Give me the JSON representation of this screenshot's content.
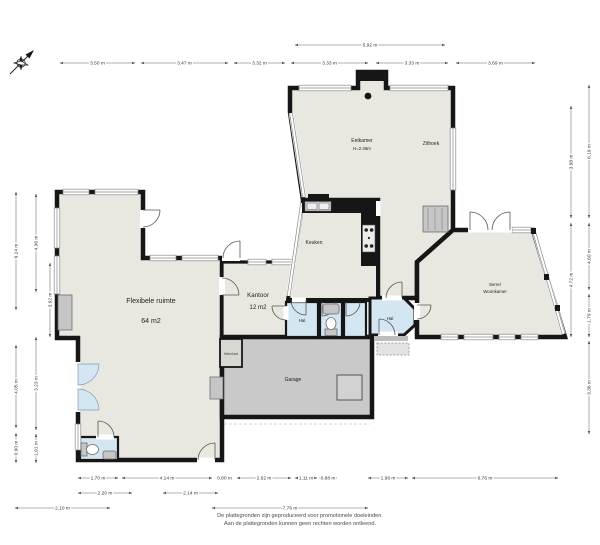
{
  "footer": {
    "line1": "De plattegronden zijn geproduceerd voor promotionele doeleinden.",
    "line2": "Aan de plattegronden kunnen geen rechten worden ontleend."
  },
  "rooms": {
    "eetkamer": {
      "label": "Eetkamer",
      "height": "H=2.46m"
    },
    "zithoek": {
      "label": "Zithoek"
    },
    "keuken": {
      "label": "Keuken"
    },
    "kantoor": {
      "label": "Kantoor",
      "area": "12 m2"
    },
    "flexibele": {
      "label": "Flexibele ruimte",
      "area": "64 m2"
    },
    "serre": {
      "line1": "Serre/",
      "line2": "Woonkamer"
    },
    "hal_left": {
      "label": "Hal"
    },
    "hal_right": {
      "label": "Hal"
    },
    "garage": {
      "label": "Garage"
    },
    "meterkast": {
      "label": "Meterkast"
    }
  },
  "colors": {
    "wall": "#161616",
    "floor": "#e9e8e0",
    "garage_floor": "#c9c9c9",
    "wet_room": "#d3e6f2",
    "fixture": "#c6c6c6"
  },
  "dimensions": [
    {
      "label": "5.92 m",
      "x1": 295,
      "y1": 45,
      "x2": 445,
      "y2": 45,
      "o": "h"
    },
    {
      "label": "3.50 m",
      "x1": 60,
      "y1": 63,
      "x2": 135,
      "y2": 63,
      "o": "h"
    },
    {
      "label": "3.47 m",
      "x1": 141,
      "y1": 63,
      "x2": 228,
      "y2": 63,
      "o": "h"
    },
    {
      "label": "3.32 m",
      "x1": 234,
      "y1": 63,
      "x2": 285,
      "y2": 63,
      "o": "h"
    },
    {
      "label": "3.33 m",
      "x1": 291,
      "y1": 63,
      "x2": 368,
      "y2": 63,
      "o": "h"
    },
    {
      "label": "3.33 m",
      "x1": 376,
      "y1": 63,
      "x2": 448,
      "y2": 63,
      "o": "h"
    },
    {
      "label": "3.69 m",
      "x1": 456,
      "y1": 63,
      "x2": 535,
      "y2": 63,
      "o": "h"
    },
    {
      "label": "9.24 m",
      "x1": 16,
      "y1": 192,
      "x2": 16,
      "y2": 310,
      "o": "v"
    },
    {
      "label": "4.05 m",
      "x1": 16,
      "y1": 345,
      "x2": 16,
      "y2": 428,
      "o": "v"
    },
    {
      "label": "0.90 m",
      "x1": 16,
      "y1": 433,
      "x2": 16,
      "y2": 463,
      "o": "v"
    },
    {
      "label": "4.36 m",
      "x1": 36,
      "y1": 194,
      "x2": 36,
      "y2": 292,
      "o": "v"
    },
    {
      "label": "3.23 m",
      "x1": 36,
      "y1": 337,
      "x2": 36,
      "y2": 430,
      "o": "v"
    },
    {
      "label": "1.91 m",
      "x1": 36,
      "y1": 434,
      "x2": 36,
      "y2": 463,
      "o": "v"
    },
    {
      "label": "3.92 m",
      "x1": 50,
      "y1": 263,
      "x2": 50,
      "y2": 337,
      "o": "v"
    },
    {
      "label": "3.98 m",
      "x1": 571,
      "y1": 106,
      "x2": 571,
      "y2": 218,
      "o": "v"
    },
    {
      "label": "4.72 m",
      "x1": 571,
      "y1": 223,
      "x2": 571,
      "y2": 337,
      "o": "v"
    },
    {
      "label": "6.19 m",
      "x1": 589,
      "y1": 85,
      "x2": 589,
      "y2": 218,
      "o": "v"
    },
    {
      "label": "4.60 m",
      "x1": 589,
      "y1": 223,
      "x2": 589,
      "y2": 290,
      "o": "v"
    },
    {
      "label": "1.79 m",
      "x1": 589,
      "y1": 294,
      "x2": 589,
      "y2": 337,
      "o": "v"
    },
    {
      "label": "3.36 m",
      "x1": 589,
      "y1": 341,
      "x2": 589,
      "y2": 434,
      "o": "v"
    },
    {
      "label": "1.70 m",
      "x1": 78,
      "y1": 478,
      "x2": 118,
      "y2": 478,
      "o": "h"
    },
    {
      "label": "4.14 m",
      "x1": 122,
      "y1": 478,
      "x2": 212,
      "y2": 478,
      "o": "h"
    },
    {
      "label": "0.80 m",
      "x1": 216,
      "y1": 478,
      "x2": 233,
      "y2": 478,
      "o": "h"
    },
    {
      "label": "2.62 m",
      "x1": 237,
      "y1": 478,
      "x2": 291,
      "y2": 478,
      "o": "h"
    },
    {
      "label": "1.11 m",
      "x1": 295,
      "y1": 478,
      "x2": 317,
      "y2": 478,
      "o": "h"
    },
    {
      "label": "0.88 m",
      "x1": 319,
      "y1": 478,
      "x2": 337,
      "y2": 478,
      "o": "h"
    },
    {
      "label": "1.98 m",
      "x1": 368,
      "y1": 478,
      "x2": 408,
      "y2": 478,
      "o": "h"
    },
    {
      "label": "6.76 m",
      "x1": 412,
      "y1": 478,
      "x2": 558,
      "y2": 478,
      "o": "h"
    },
    {
      "label": "2.20 m",
      "x1": 78,
      "y1": 493,
      "x2": 132,
      "y2": 493,
      "o": "h"
    },
    {
      "label": "2.14 m",
      "x1": 163,
      "y1": 493,
      "x2": 218,
      "y2": 493,
      "o": "h"
    },
    {
      "label": "2.10 m",
      "x1": 15,
      "y1": 508,
      "x2": 110,
      "y2": 508,
      "o": "h"
    },
    {
      "label": "7.76 m",
      "x1": 212,
      "y1": 508,
      "x2": 368,
      "y2": 508,
      "o": "h"
    }
  ]
}
